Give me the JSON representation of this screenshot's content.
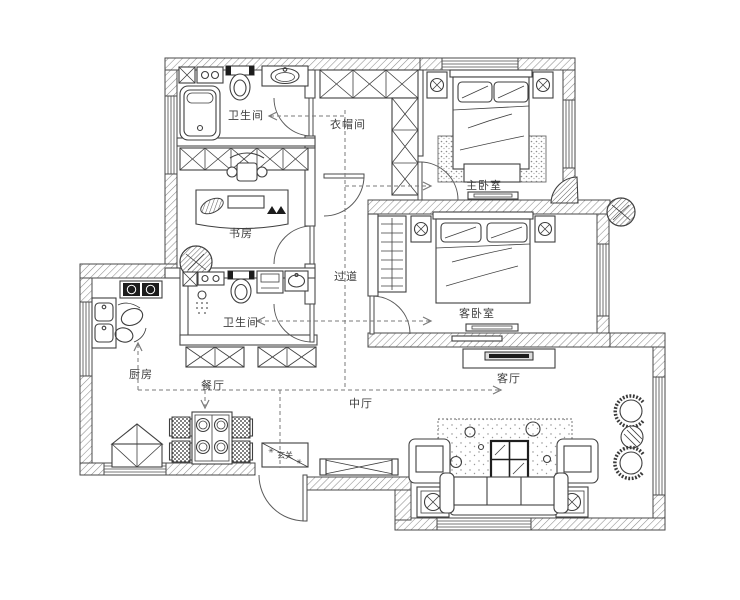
{
  "page": {
    "background": "#ffffff",
    "ink_color": "#3f3f3f",
    "wall_hatch_color": "#8d8d8d",
    "top_border_colors": [
      "#a88a5e",
      "#cfc0a4",
      "#ffffff"
    ]
  },
  "floorplan": {
    "labels": {
      "bathroom_top": "卫生间",
      "cloakroom": "衣帽间",
      "master_bedroom": "主卧室",
      "study": "书房",
      "corridor": "过道",
      "guest_bedroom": "客卧室",
      "bathroom_mid": "卫生间",
      "kitchen": "厨房",
      "dining_room": "餐厅",
      "middle_hall": "中厅",
      "foyer": "玄关",
      "living_room": "客厅"
    },
    "icons": {
      "sparkle": "✳"
    }
  }
}
